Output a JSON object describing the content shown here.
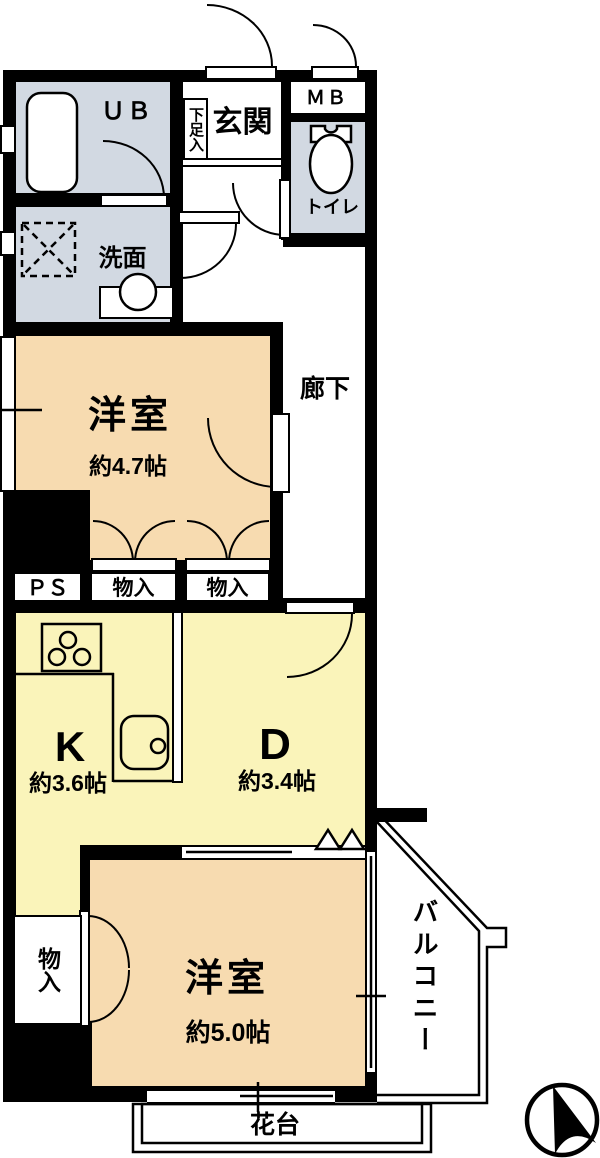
{
  "colors": {
    "wet_area_fill": "#d2d9e2",
    "bedroom_fill": "#f7dbb0",
    "kitchen_dining_fill": "#faf4ba",
    "wall": "#000000",
    "background": "#ffffff"
  },
  "rooms": {
    "unit_bath": "ＵＢ",
    "shoe_cabinet": "下足入",
    "entrance": "玄関",
    "meter_box": "ＭＢ",
    "toilet": "トイレ",
    "washroom": "洗面",
    "bedroom1": "洋室",
    "bedroom1_area": "約4.7帖",
    "corridor": "廊下",
    "pipe_space": "ＰＳ",
    "closet1": "物入",
    "closet2": "物入",
    "kitchen": "K",
    "kitchen_area": "約3.6帖",
    "dining": "D",
    "dining_area": "約3.4帖",
    "closet3": "物入",
    "bedroom2": "洋室",
    "bedroom2_area": "約5.0帖",
    "balcony": "バルコニー",
    "flower_stand": "花台"
  }
}
